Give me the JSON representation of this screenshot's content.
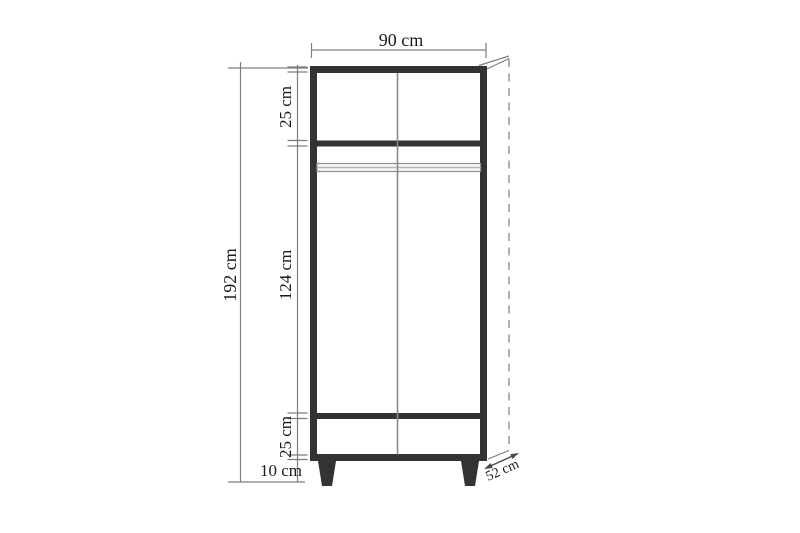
{
  "diagram": {
    "subject": "wardrobe-dimension-drawing",
    "labels": {
      "width": "90 cm",
      "height": "192 cm",
      "top_section": "25 cm",
      "middle_section": "124 cm",
      "bottom_section": "25 cm",
      "leg_height": "10 cm",
      "depth": "52 cm"
    },
    "colors": {
      "outline": "#333333",
      "dimension_line": "#7d7d7d",
      "depth_arrow": "#4a4a4a",
      "rail": "#8f8f8f",
      "text": "#1b1b1b",
      "background": "#ffffff"
    }
  }
}
